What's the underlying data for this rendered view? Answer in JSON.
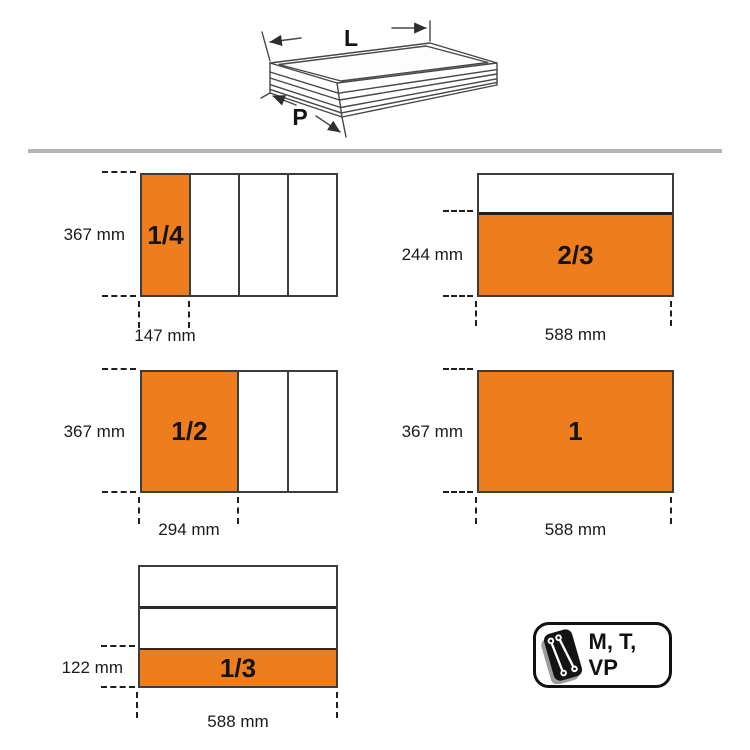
{
  "illustration": {
    "length_label": "L",
    "depth_label": "P",
    "description": "isometric line drawing of a tool chest drawer with length L and depth P dimension arrows"
  },
  "diagrams": [
    {
      "id": "quarter",
      "fraction": "1/4",
      "height_label": "367 mm",
      "width_label": "147 mm",
      "sections": {
        "orientation": "vertical",
        "count": 4,
        "highlighted_index": 0
      }
    },
    {
      "id": "two-thirds",
      "fraction": "2/3",
      "height_label": "244 mm",
      "width_label": "588 mm",
      "sections": {
        "orientation": "horizontal",
        "count": 2,
        "highlighted_index": 1
      }
    },
    {
      "id": "half",
      "fraction": "1/2",
      "height_label": "367 mm",
      "width_label": "294 mm",
      "sections": {
        "orientation": "vertical",
        "count": 3,
        "highlighted_index": 0
      }
    },
    {
      "id": "full",
      "fraction": "1",
      "height_label": "367 mm",
      "width_label": "588 mm",
      "sections": {
        "orientation": "single",
        "count": 1,
        "highlighted_index": 0
      }
    },
    {
      "id": "third",
      "fraction": "1/3",
      "height_label": "122 mm",
      "width_label": "588 mm",
      "sections": {
        "orientation": "horizontal",
        "count": 3,
        "highlighted_index": 2
      }
    }
  ],
  "badge": {
    "label": "M, T, VP",
    "icon": "wrenches-tray-icon"
  },
  "colors": {
    "accent_orange": "#EE7D1E",
    "line_dark": "#3c3c3c",
    "divider_gray": "#b5b5b5"
  }
}
